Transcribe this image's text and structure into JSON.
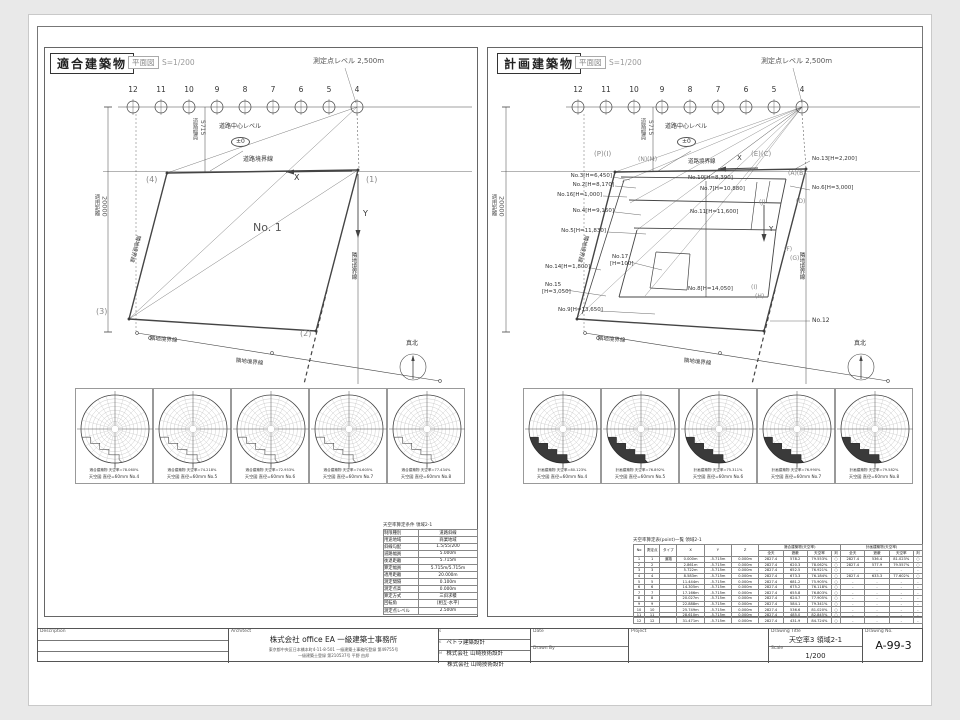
{
  "accent": {
    "line_color": "#444",
    "sheet_bg": "#ffffff",
    "page_bg": "#e9e9e9"
  },
  "points": {
    "labels": [
      "12",
      "11",
      "10",
      "9",
      "8",
      "7",
      "6",
      "5",
      "4"
    ]
  },
  "panels": {
    "left": {
      "title": "適合建築物",
      "subtitle": "平面図",
      "scale_note": "S=1/200",
      "labels": [
        {
          "t": "測定点レベル 2,500m",
          "x": 313,
          "y": 58,
          "fs": 7,
          "c": "#555"
        },
        {
          "t": "道路中心レベル",
          "x": 219,
          "y": 124,
          "fs": 6
        },
        {
          "t": "±0",
          "x": 231,
          "y": 137,
          "fs": 6,
          "ell": 1
        },
        {
          "t": "道路幅員",
          "x": 191,
          "y": 118,
          "fs": 5.5,
          "vert": 1,
          "c": "#555"
        },
        {
          "t": "5715",
          "x": 199,
          "y": 120,
          "fs": 6,
          "vert": 1,
          "c": "#555"
        },
        {
          "t": "適用距離",
          "x": 93,
          "y": 194,
          "fs": 5.5,
          "vert": 1,
          "c": "#555"
        },
        {
          "t": "20000",
          "x": 101,
          "y": 196,
          "fs": 6.5,
          "vert": 1,
          "c": "#555"
        },
        {
          "t": "道路境界線",
          "x": 243,
          "y": 157,
          "fs": 6
        },
        {
          "t": "X",
          "x": 294,
          "y": 174,
          "fs": 8
        },
        {
          "t": "Y",
          "x": 363,
          "y": 210,
          "fs": 8
        },
        {
          "t": "(4)",
          "x": 146,
          "y": 176,
          "fs": 8,
          "c": "#888"
        },
        {
          "t": "(1)",
          "x": 366,
          "y": 176,
          "fs": 8,
          "c": "#888"
        },
        {
          "t": "(3)",
          "x": 96,
          "y": 308,
          "fs": 8,
          "c": "#888"
        },
        {
          "t": "(2)",
          "x": 300,
          "y": 330,
          "fs": 8,
          "c": "#888"
        },
        {
          "t": "No. 1",
          "x": 253,
          "y": 222,
          "fs": 11,
          "c": "#555"
        },
        {
          "t": "隣地境界線",
          "x": 140,
          "y": 236,
          "fs": 5.5,
          "rot": 105
        },
        {
          "t": "隣地境界線",
          "x": 150,
          "y": 337,
          "fs": 5.5,
          "rot": 4
        },
        {
          "t": "隣地境界線",
          "x": 236,
          "y": 359,
          "fs": 5.5,
          "rot": 6
        },
        {
          "t": "隣地境界線",
          "x": 350,
          "y": 252,
          "fs": 5.5,
          "vert": 1
        },
        {
          "t": "真北",
          "x": 406,
          "y": 341,
          "fs": 6
        }
      ]
    },
    "right": {
      "title": "計画建築物",
      "subtitle": "平面図",
      "scale_note": "S=1/200",
      "labels": [
        {
          "t": "測定点レベル 2,500m",
          "x": 761,
          "y": 58,
          "fs": 7,
          "c": "#555"
        },
        {
          "t": "道路中心レベル",
          "x": 665,
          "y": 124,
          "fs": 6
        },
        {
          "t": "±0",
          "x": 677,
          "y": 137,
          "fs": 6,
          "ell": 1
        },
        {
          "t": "道路幅員",
          "x": 639,
          "y": 118,
          "fs": 5.5,
          "vert": 1,
          "c": "#555"
        },
        {
          "t": "5715",
          "x": 647,
          "y": 120,
          "fs": 6,
          "vert": 1,
          "c": "#555"
        },
        {
          "t": "適用距離",
          "x": 490,
          "y": 194,
          "fs": 5.5,
          "vert": 1,
          "c": "#555"
        },
        {
          "t": "20000",
          "x": 498,
          "y": 196,
          "fs": 6.5,
          "vert": 1,
          "c": "#555"
        },
        {
          "t": "道路境界線",
          "x": 688,
          "y": 160,
          "fs": 5.5
        },
        {
          "t": "X",
          "x": 737,
          "y": 155,
          "fs": 7
        },
        {
          "t": "Y",
          "x": 769,
          "y": 226,
          "fs": 7
        },
        {
          "t": "(P)(I)",
          "x": 594,
          "y": 151,
          "fs": 7,
          "c": "#888"
        },
        {
          "t": "(N)(M)",
          "x": 638,
          "y": 157,
          "fs": 6,
          "c": "#888"
        },
        {
          "t": "(E)(C)",
          "x": 751,
          "y": 151,
          "fs": 7,
          "c": "#888"
        },
        {
          "t": "(A)(B)",
          "x": 788,
          "y": 171,
          "fs": 6,
          "c": "#888"
        },
        {
          "t": "(D)",
          "x": 796,
          "y": 199,
          "fs": 6,
          "c": "#888"
        },
        {
          "t": "(J)",
          "x": 759,
          "y": 200,
          "fs": 6,
          "c": "#888"
        },
        {
          "t": "(F)",
          "x": 784,
          "y": 247,
          "fs": 6,
          "c": "#888"
        },
        {
          "t": "(G)",
          "x": 790,
          "y": 256,
          "fs": 6,
          "c": "#888"
        },
        {
          "t": "(I)",
          "x": 751,
          "y": 285,
          "fs": 6,
          "c": "#888"
        },
        {
          "t": "(H)",
          "x": 755,
          "y": 294,
          "fs": 6,
          "c": "#888"
        },
        {
          "t": "No.12",
          "x": 812,
          "y": 318,
          "fs": 6
        },
        {
          "t": "No.3[H=6,450]",
          "x": 612,
          "y": 174,
          "fs": 5.5,
          "end": 1
        },
        {
          "t": "No.2[H=8,170]",
          "x": 614,
          "y": 183,
          "fs": 5.5,
          "end": 1
        },
        {
          "t": "No.16[H=1,000]",
          "x": 602,
          "y": 193,
          "fs": 5.5,
          "end": 1
        },
        {
          "t": "No.4[H=9,160]",
          "x": 614,
          "y": 209,
          "fs": 5.5,
          "end": 1
        },
        {
          "t": "No.5[H=11,830]",
          "x": 606,
          "y": 229,
          "fs": 5.5,
          "end": 1
        },
        {
          "t": "No.14[H=1,800]",
          "x": 590,
          "y": 265,
          "fs": 5.5,
          "end": 1
        },
        {
          "t": "No.15",
          "x": 545,
          "y": 283,
          "fs": 5.5
        },
        {
          "t": "[H=3,050]",
          "x": 542,
          "y": 290,
          "fs": 5.5
        },
        {
          "t": "No.9[H=13,650]",
          "x": 558,
          "y": 308,
          "fs": 5.5
        },
        {
          "t": "No.10[H=8,390]",
          "x": 688,
          "y": 176,
          "fs": 5.5
        },
        {
          "t": "No.7[H=10,880]",
          "x": 700,
          "y": 187,
          "fs": 5.5
        },
        {
          "t": "No.11[H=11,600]",
          "x": 690,
          "y": 210,
          "fs": 5.5
        },
        {
          "t": "No.17",
          "x": 612,
          "y": 255,
          "fs": 5.5
        },
        {
          "t": "[H=100]",
          "x": 610,
          "y": 262,
          "fs": 5.5
        },
        {
          "t": "No.8[H=14,050]",
          "x": 688,
          "y": 287,
          "fs": 5.5
        },
        {
          "t": "No.13[H=2,200]",
          "x": 812,
          "y": 157,
          "fs": 5.5
        },
        {
          "t": "No.6[H=3,000]",
          "x": 812,
          "y": 186,
          "fs": 5.5
        },
        {
          "t": "隣地境界線",
          "x": 588,
          "y": 236,
          "fs": 5.5,
          "rot": 105
        },
        {
          "t": "隣地境界線",
          "x": 598,
          "y": 337,
          "fs": 5.5,
          "rot": 4
        },
        {
          "t": "隣地境界線",
          "x": 684,
          "y": 359,
          "fs": 5.5,
          "rot": 6
        },
        {
          "t": "隣地境界線",
          "x": 798,
          "y": 252,
          "fs": 5.5,
          "vert": 1
        },
        {
          "t": "真北",
          "x": 854,
          "y": 341,
          "fs": 6
        }
      ]
    }
  },
  "sky": {
    "left": {
      "filled": false,
      "cells": [
        {
          "l1": "適合建築物 天空率=78.060%",
          "l2": "天空図 直径=60mm No.4"
        },
        {
          "l1": "適合建築物 天空率=74.218%",
          "l2": "天空図 直径=60mm No.5"
        },
        {
          "l1": "適合建築物 天空率=72.953%",
          "l2": "天空図 直径=60mm No.6"
        },
        {
          "l1": "適合建築物 天空率=74.605%",
          "l2": "天空図 直径=60mm No.7"
        },
        {
          "l1": "適合建築物 天空率=77.434%",
          "l2": "天空図 直径=60mm No.8"
        }
      ]
    },
    "right": {
      "filled": true,
      "cells": [
        {
          "l1": "計画建築物 天空率=80.123%",
          "l2": "天空図 直径=60mm No.4"
        },
        {
          "l1": "計画建築物 天空率=76.892%",
          "l2": "天空図 直径=60mm No.5"
        },
        {
          "l1": "計画建築物 天空率=75.311%",
          "l2": "天空図 直径=60mm No.6"
        },
        {
          "l1": "計画建築物 天空率=76.990%",
          "l2": "天空図 直径=60mm No.7"
        },
        {
          "l1": "計画建築物 天空率=79.582%",
          "l2": "天空図 直径=60mm No.8"
        }
      ]
    }
  },
  "cond_table": {
    "title": "天空率算定条件 領域2-1",
    "rows": [
      [
        "制限種別",
        "道路斜線"
      ],
      [
        "用途地域",
        "商業地域"
      ],
      [
        "斜線勾配",
        "1.5/55/200"
      ],
      [
        "道路幅員",
        "5.000m"
      ],
      [
        "後退距離",
        "5.715m"
      ],
      [
        "算定幅員",
        "5.715m/5.715m"
      ],
      [
        "適用距離",
        "20.000m"
      ],
      [
        "測定間隔",
        "0.100m"
      ],
      [
        "測定点高",
        "0.000m"
      ],
      [
        "算定方式",
        "三斜求積"
      ],
      [
        "回転角",
        "[相互-水平]"
      ],
      [
        "測定点レベル",
        "2.500m"
      ]
    ]
  },
  "result_table": {
    "title": "天空率算定表(point)一覧 領域2-1",
    "headers": [
      "No",
      "測定点",
      "タイプ",
      "X",
      "Y",
      "Z"
    ],
    "group1": "適合建築物(天空率)",
    "group2": "計画建築物(天空率)",
    "sub": [
      "全天",
      "遮蔽",
      "天空率",
      "判"
    ],
    "rows": [
      [
        "1",
        "1",
        "道路",
        "0.000m",
        "-5.715m",
        "0.000m",
        "2827.4",
        "578.2",
        "79.553%",
        "○",
        "2827.4",
        "536.4",
        "81.023%",
        "○"
      ],
      [
        "2",
        "2",
        "",
        "2.861m",
        "-5.715m",
        "0.000m",
        "2827.4",
        "620.3",
        "78.062%",
        "○",
        "2827.4",
        "577.9",
        "79.557%",
        "○"
      ],
      [
        "3",
        "3",
        "",
        "5.722m",
        "-5.715m",
        "0.000m",
        "2827.4",
        "652.5",
        "76.921%",
        "○",
        "-",
        "-",
        "-",
        "-"
      ],
      [
        "4",
        "4",
        "",
        "8.583m",
        "-5.715m",
        "0.000m",
        "2827.4",
        "673.3",
        "76.184%",
        "○",
        "2827.4",
        "633.3",
        "77.602%",
        "○"
      ],
      [
        "5",
        "5",
        "",
        "11.444m",
        "-5.715m",
        "0.000m",
        "2827.4",
        "681.2",
        "75.905%",
        "○",
        "-",
        "-",
        "-",
        "-"
      ],
      [
        "6",
        "6",
        "",
        "14.305m",
        "-5.715m",
        "0.000m",
        "2827.4",
        "675.2",
        "76.118%",
        "○",
        "-",
        "-",
        "-",
        "-"
      ],
      [
        "7",
        "7",
        "",
        "17.166m",
        "-5.715m",
        "0.000m",
        "2827.4",
        "655.8",
        "76.803%",
        "○",
        "-",
        "-",
        "-",
        "-"
      ],
      [
        "8",
        "8",
        "",
        "20.027m",
        "-5.715m",
        "0.000m",
        "2827.4",
        "624.7",
        "77.905%",
        "○",
        "-",
        "-",
        "-",
        "-"
      ],
      [
        "9",
        "9",
        "",
        "22.888m",
        "-5.715m",
        "0.000m",
        "2827.4",
        "584.1",
        "79.341%",
        "○",
        "-",
        "-",
        "-",
        "-"
      ],
      [
        "10",
        "10",
        "",
        "25.749m",
        "-5.715m",
        "0.000m",
        "2827.4",
        "536.6",
        "81.020%",
        "○",
        "-",
        "-",
        "-",
        "-"
      ],
      [
        "11",
        "11",
        "",
        "28.610m",
        "-5.715m",
        "0.000m",
        "2827.4",
        "485.0",
        "82.845%",
        "○",
        "-",
        "-",
        "-",
        "-"
      ],
      [
        "12",
        "12",
        "",
        "31.471m",
        "-5.715m",
        "0.000m",
        "2827.4",
        "431.9",
        "84.724%",
        "○",
        "-",
        "-",
        "-",
        "-"
      ]
    ]
  },
  "title_block": {
    "description_label": "Description",
    "architect_label": "Architect",
    "architect_name": "株式会社  office EA  一級建築士事務所",
    "architect_addr1": "東京都中央区日本橋本町4-11-8-501  一級建築士事務所登録  第49755号",
    "architect_addr2": "一級建築士登録  第210537号  平野 由邦",
    "consultants": [
      {
        "prefix": "S",
        "name": "ペトラ建築設計"
      },
      {
        "prefix": "K",
        "name": "株式会社 山崎技術設計"
      },
      {
        "prefix": "M",
        "name": "株式会社 山崎技術設計"
      }
    ],
    "date_label": "Date",
    "drawn_by_label": "Drawn By",
    "project_label": "Project",
    "drawing_title_label": "Drawing Title",
    "drawing_title": "天空率3  領域2-1",
    "scale_label": "Scale",
    "scale": "1/200",
    "drawing_no_label": "Drawing No.",
    "drawing_no": "A-99-3"
  }
}
